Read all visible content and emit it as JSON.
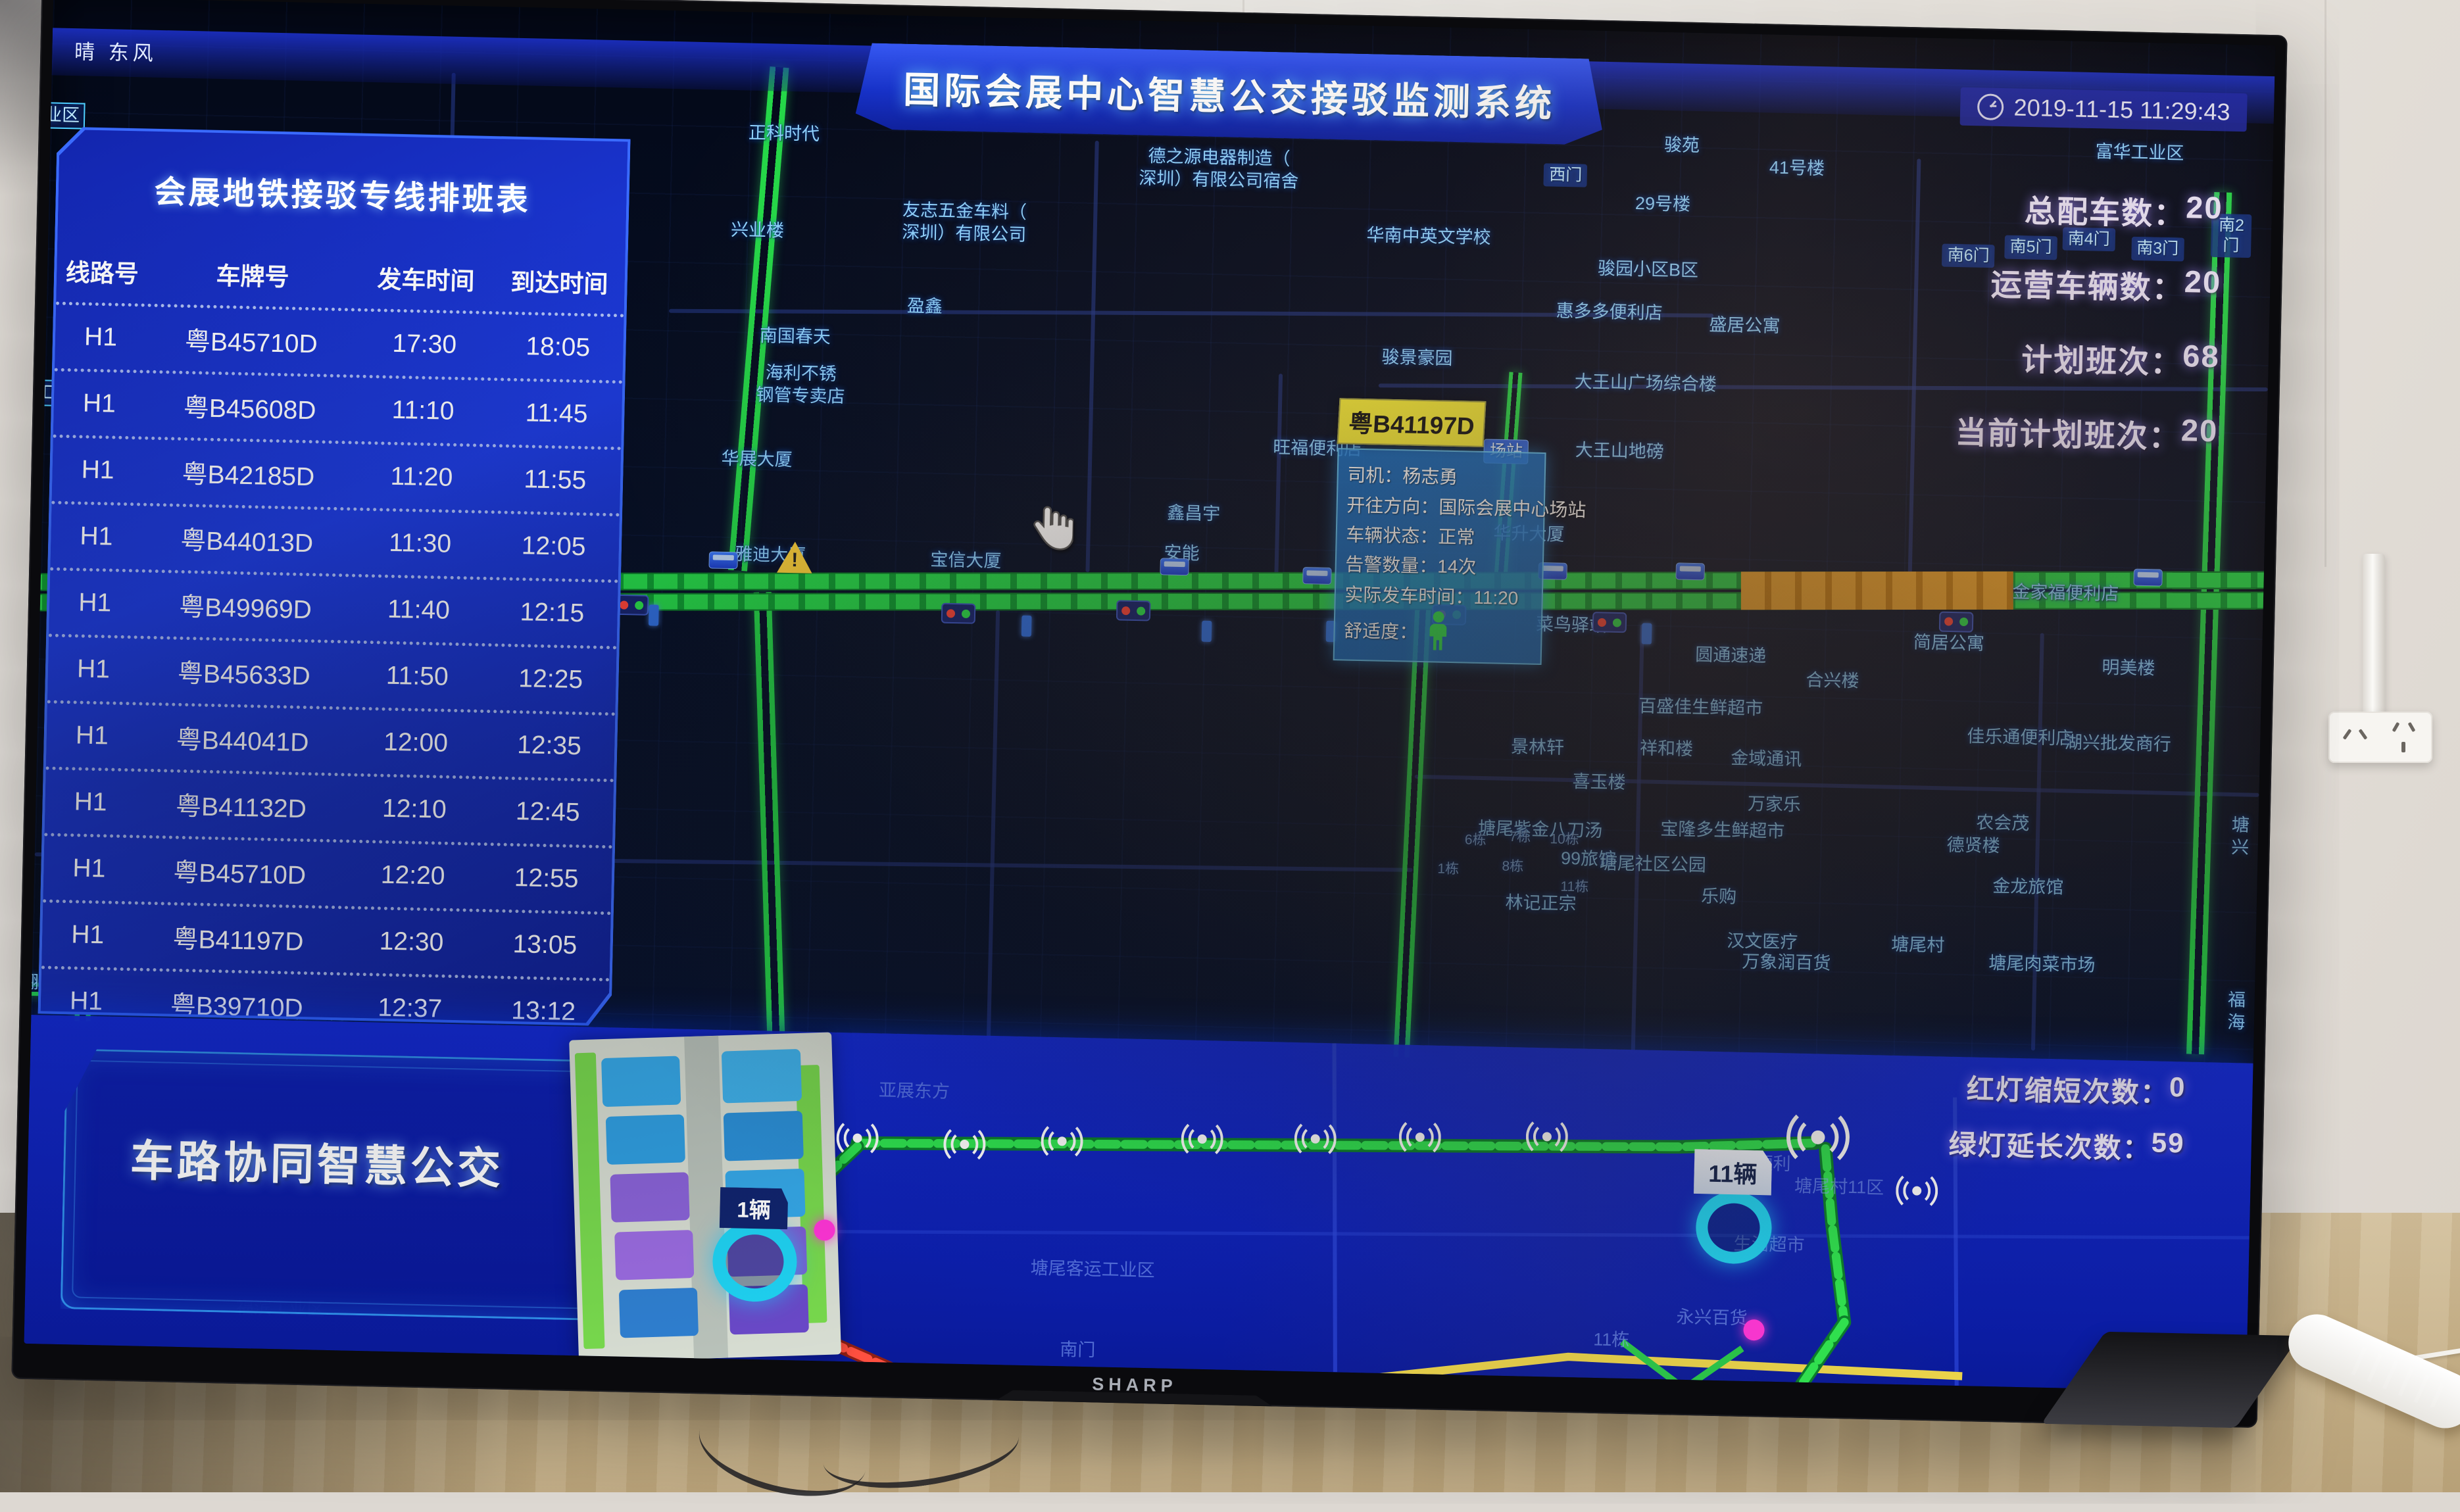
{
  "tv": {
    "brand": "SHARP"
  },
  "weather": "晴 东风",
  "header": {
    "title": "国际会展中心智慧公交接驳监测系统",
    "datetime": "2019-11-15 11:29:43"
  },
  "stats": [
    {
      "label": "总配车数",
      "sep": "：",
      "value": "20"
    },
    {
      "label": "运营车辆数",
      "sep": "：",
      "value": "20"
    },
    {
      "label": "计划班次",
      "sep": "：",
      "value": "68"
    },
    {
      "label": "当前计划班次",
      "sep": "：",
      "value": "20"
    }
  ],
  "schedule": {
    "title": "会展地铁接驳专线排班表",
    "columns": [
      "线路号",
      "车牌号",
      "发车时间",
      "到达时间"
    ],
    "rows": [
      {
        "line": "H1",
        "plate": "粤B45710D",
        "dep": "17:30",
        "arr": "18:05"
      },
      {
        "line": "H1",
        "plate": "粤B45608D",
        "dep": "11:10",
        "arr": "11:45"
      },
      {
        "line": "H1",
        "plate": "粤B42185D",
        "dep": "11:20",
        "arr": "11:55"
      },
      {
        "line": "H1",
        "plate": "粤B44013D",
        "dep": "11:30",
        "arr": "12:05"
      },
      {
        "line": "H1",
        "plate": "粤B49969D",
        "dep": "11:40",
        "arr": "12:15"
      },
      {
        "line": "H1",
        "plate": "粤B45633D",
        "dep": "11:50",
        "arr": "12:25"
      },
      {
        "line": "H1",
        "plate": "粤B44041D",
        "dep": "12:00",
        "arr": "12:35"
      },
      {
        "line": "H1",
        "plate": "粤B41132D",
        "dep": "12:10",
        "arr": "12:45"
      },
      {
        "line": "H1",
        "plate": "粤B45710D",
        "dep": "12:20",
        "arr": "12:55"
      },
      {
        "line": "H1",
        "plate": "粤B41197D",
        "dep": "12:30",
        "arr": "13:05"
      },
      {
        "line": "H1",
        "plate": "粤B39710D",
        "dep": "12:37",
        "arr": "13:12"
      },
      {
        "line": "H1",
        "plate": "粤B4",
        "dep": "12:44",
        "arr": "13:19",
        "clipped": true
      }
    ]
  },
  "popup": {
    "plate": "粤B41197D",
    "rows": [
      {
        "label": "司机",
        "sep": "：",
        "value": "杨志勇"
      },
      {
        "label": "开往方向",
        "sep": "：",
        "value": "国际会展中心场站"
      },
      {
        "label": "车辆状态",
        "sep": "：",
        "value": "正常"
      },
      {
        "label": "告警数量",
        "sep": "：",
        "value": "14次"
      },
      {
        "label": "实际发车时间",
        "sep": "：",
        "value": "11:20"
      },
      {
        "label": "舒适度",
        "sep": "：",
        "value": "",
        "icon": "person-icon"
      }
    ]
  },
  "bottom": {
    "title": "车路协同智慧公交",
    "badge_left": "1辆",
    "badge_right": "11辆",
    "signal_stats": [
      {
        "label": "红灯缩短次数",
        "sep": "：",
        "value": "0"
      },
      {
        "label": "绿灯延长次数",
        "sep": "：",
        "value": "59"
      }
    ]
  },
  "map": {
    "labels": [
      {
        "t": "业区",
        "x": 0.5,
        "y": 8.8,
        "cls": "boxed"
      },
      {
        "t": "正科时代",
        "x": 33.0,
        "y": 9.0
      },
      {
        "t": "友志五金车料（\n深圳）有限公司",
        "x": 41.2,
        "y": 15.3
      },
      {
        "t": "德之源电器制造（\n深圳）有限公司宿舍",
        "x": 52.6,
        "y": 10.9
      },
      {
        "t": "华南中英文学校",
        "x": 62.1,
        "y": 15.6
      },
      {
        "t": "盈鑫",
        "x": 39.5,
        "y": 21.6
      },
      {
        "t": "骏苑",
        "x": 73.4,
        "y": 8.4
      },
      {
        "t": "西门",
        "x": 68.2,
        "y": 10.8,
        "cls": "gate"
      },
      {
        "t": "41号楼",
        "x": 78.6,
        "y": 9.9
      },
      {
        "t": "29号楼",
        "x": 72.6,
        "y": 12.8
      },
      {
        "t": "骏园小区B区",
        "x": 72.0,
        "y": 17.7
      },
      {
        "t": "惠多多便利店",
        "x": 70.3,
        "y": 20.9
      },
      {
        "t": "盛居公寓",
        "x": 76.4,
        "y": 21.7
      },
      {
        "t": "骏景豪园",
        "x": 61.7,
        "y": 24.6
      },
      {
        "t": "大王山广场综合楼",
        "x": 72.0,
        "y": 26.1
      },
      {
        "t": "大王山地磅",
        "x": 70.9,
        "y": 31.2
      },
      {
        "t": "南6门",
        "x": 86.4,
        "y": 16.1,
        "cls": "gate"
      },
      {
        "t": "南5门",
        "x": 89.2,
        "y": 15.4,
        "cls": "gate"
      },
      {
        "t": "南4门",
        "x": 91.8,
        "y": 14.7,
        "cls": "gate"
      },
      {
        "t": "南3门",
        "x": 94.9,
        "y": 15.3,
        "cls": "gate"
      },
      {
        "t": "南2门",
        "x": 98.2,
        "y": 14.2,
        "cls": "gate"
      },
      {
        "t": "兴业楼",
        "x": 31.9,
        "y": 16.2
      },
      {
        "t": "南国春天",
        "x": 33.7,
        "y": 24.0
      },
      {
        "t": "海利不锈\n钢管专卖店",
        "x": 34.0,
        "y": 27.6
      },
      {
        "t": "工业区",
        "x": 0.8,
        "y": 29.4,
        "cls": "boxed"
      },
      {
        "t": "上星百都\n工业区B栋",
        "x": 13.5,
        "y": 32.2
      },
      {
        "t": "华展大厦",
        "x": 32.1,
        "y": 33.2
      },
      {
        "t": "雅迪大厦",
        "x": 32.8,
        "y": 40.3
      },
      {
        "t": "宝信大厦",
        "x": 41.6,
        "y": 40.4
      },
      {
        "t": "鑫昌宇",
        "x": 51.8,
        "y": 36.5
      },
      {
        "t": "安能",
        "x": 51.3,
        "y": 39.5
      },
      {
        "t": "旺福便利店",
        "x": 57.3,
        "y": 31.5
      },
      {
        "t": "华升大厦",
        "x": 66.9,
        "y": 37.5
      },
      {
        "t": "场站",
        "x": 65.8,
        "y": 31.4,
        "cls": "chip"
      },
      {
        "t": "金家福便利店",
        "x": 91.1,
        "y": 41.0
      },
      {
        "t": "富华工业区",
        "x": 94.0,
        "y": 8.2
      },
      {
        "t": "菜鸟驿站",
        "x": 68.9,
        "y": 44.2
      },
      {
        "t": "圆通速递",
        "x": 76.1,
        "y": 46.2
      },
      {
        "t": "简居公寓",
        "x": 85.9,
        "y": 44.9
      },
      {
        "t": "明美楼",
        "x": 94.0,
        "y": 46.5
      },
      {
        "t": "合兴楼",
        "x": 80.7,
        "y": 47.9
      },
      {
        "t": "百盛佳生鲜超市",
        "x": 74.8,
        "y": 50.1
      },
      {
        "t": "佳乐通便利店",
        "x": 89.2,
        "y": 51.8
      },
      {
        "t": "湖兴批发商行",
        "x": 93.6,
        "y": 52.1
      },
      {
        "t": "景林轩",
        "x": 67.5,
        "y": 53.3
      },
      {
        "t": "祥和楼",
        "x": 73.3,
        "y": 53.2
      },
      {
        "t": "金域通讯",
        "x": 77.8,
        "y": 53.8
      },
      {
        "t": "喜玉楼",
        "x": 70.3,
        "y": 55.8
      },
      {
        "t": "万家乐",
        "x": 78.2,
        "y": 57.2
      },
      {
        "t": "宝隆多生鲜超市",
        "x": 75.9,
        "y": 59.2
      },
      {
        "t": "农会茂",
        "x": 88.5,
        "y": 58.2
      },
      {
        "t": "塘尾紫金八刀汤",
        "x": 67.7,
        "y": 59.4
      },
      {
        "t": "99旅馆",
        "x": 69.9,
        "y": 61.5
      },
      {
        "t": "塘尾社区公园",
        "x": 72.8,
        "y": 61.8
      },
      {
        "t": "德贤楼",
        "x": 87.2,
        "y": 59.9
      },
      {
        "t": "金龙旅馆",
        "x": 89.7,
        "y": 62.9
      },
      {
        "t": "乐购",
        "x": 75.8,
        "y": 64.1
      },
      {
        "t": "林记正宗",
        "x": 67.8,
        "y": 64.9
      },
      {
        "t": "汉文医疗",
        "x": 77.8,
        "y": 67.4
      },
      {
        "t": "万象润百货",
        "x": 78.9,
        "y": 68.9
      },
      {
        "t": "塘尾村",
        "x": 84.8,
        "y": 67.4
      },
      {
        "t": "塘尾肉菜市场",
        "x": 90.4,
        "y": 68.6
      },
      {
        "t": "翻身实验学\n校（西校区）",
        "x": 1.5,
        "y": 74.0
      },
      {
        "t": "怀德公寓",
        "x": 12.6,
        "y": 75.0
      },
      {
        "t": "1栋",
        "x": 63.6,
        "y": 62.5,
        "cls": "tiny"
      },
      {
        "t": "6栋",
        "x": 64.8,
        "y": 60.3,
        "cls": "tiny"
      },
      {
        "t": "7栋",
        "x": 66.8,
        "y": 60.0,
        "cls": "tiny"
      },
      {
        "t": "10栋",
        "x": 68.8,
        "y": 60.1,
        "cls": "tiny"
      },
      {
        "t": "8栋",
        "x": 66.5,
        "y": 62.2,
        "cls": "tiny"
      },
      {
        "t": "11栋",
        "x": 69.3,
        "y": 63.6,
        "cls": "tiny"
      },
      {
        "t": "塘兴",
        "x": 99.2,
        "y": 58.8
      },
      {
        "t": "福海",
        "x": 99.2,
        "y": 71.8
      },
      {
        "t": "福滨工业区",
        "x": 11.5,
        "y": 97.0
      }
    ]
  },
  "bottom_labels": [
    {
      "t": "亚展东方",
      "x": 39.8,
      "y": 16.8
    },
    {
      "t": "吉叶便利",
      "x": 77.7,
      "y": 33.2
    },
    {
      "t": "塘尾村11区",
      "x": 81.5,
      "y": 39.8
    },
    {
      "t": "生活超市",
      "x": 78.4,
      "y": 57.8
    },
    {
      "t": "塘尾客运工业区",
      "x": 48.0,
      "y": 69.7
    },
    {
      "t": "永兴百货",
      "x": 75.9,
      "y": 80.3
    },
    {
      "t": "南门",
      "x": 47.4,
      "y": 94.3
    },
    {
      "t": "11栋",
      "x": 71.4,
      "y": 87.7
    }
  ],
  "markers": [
    {
      "type": "traffic-light-icon",
      "x": 13.6,
      "y": 44.1
    },
    {
      "type": "traffic-light-icon",
      "x": 19.8,
      "y": 43.9
    },
    {
      "type": "traffic-light-icon",
      "x": 26.6,
      "y": 44.2
    },
    {
      "type": "traffic-light-icon",
      "x": 41.3,
      "y": 44.3
    },
    {
      "type": "traffic-light-icon",
      "x": 49.2,
      "y": 43.8
    },
    {
      "type": "traffic-light-icon",
      "x": 63.4,
      "y": 43.6
    },
    {
      "type": "traffic-light-icon",
      "x": 70.6,
      "y": 43.9
    },
    {
      "type": "traffic-light-icon",
      "x": 86.2,
      "y": 43.3
    },
    {
      "type": "bus-icon",
      "x": 30.7,
      "y": 40.7
    },
    {
      "type": "bus-icon",
      "x": 51.0,
      "y": 40.5
    },
    {
      "type": "bus-icon",
      "x": 57.4,
      "y": 40.9
    },
    {
      "type": "bus-icon",
      "x": 68.0,
      "y": 40.2
    },
    {
      "type": "bus-icon",
      "x": 74.2,
      "y": 40.0
    },
    {
      "type": "bus-icon",
      "x": 94.8,
      "y": 39.7
    },
    {
      "type": "sign-icon",
      "x": 27.6,
      "y": 44.9
    },
    {
      "type": "sign-icon",
      "x": 44.4,
      "y": 45.1
    },
    {
      "type": "sign-icon",
      "x": 52.5,
      "y": 45.2
    },
    {
      "type": "sign-icon",
      "x": 58.1,
      "y": 45.0
    },
    {
      "type": "sign-icon",
      "x": 72.3,
      "y": 44.7
    },
    {
      "type": "warning-icon",
      "x": 33.9,
      "y": 40.4
    }
  ],
  "bottom_markers": [
    {
      "type": "wifi-icon",
      "x": 37.3,
      "y": 32.0
    },
    {
      "type": "wifi-icon",
      "x": 42.1,
      "y": 33.2
    },
    {
      "type": "wifi-icon",
      "x": 46.5,
      "y": 31.6
    },
    {
      "type": "wifi-icon",
      "x": 52.8,
      "y": 29.9
    },
    {
      "type": "wifi-icon",
      "x": 57.9,
      "y": 29.1
    },
    {
      "type": "wifi-icon",
      "x": 62.6,
      "y": 27.9
    },
    {
      "type": "wifi-icon",
      "x": 68.3,
      "y": 27.0
    },
    {
      "type": "wifi-icon",
      "x": 80.5,
      "y": 25.4,
      "s": 1.5
    },
    {
      "type": "wifi-icon",
      "x": 85.0,
      "y": 41.0
    },
    {
      "type": "stop-icon",
      "x": 32.8,
      "y": 70.1
    },
    {
      "type": "stop-icon",
      "x": 76.8,
      "y": 53.3,
      "s": 0.9
    },
    {
      "type": "vehicle-dot",
      "x": 35.9,
      "y": 60.2
    },
    {
      "type": "vehicle-dot",
      "x": 77.8,
      "y": 84.4
    }
  ]
}
